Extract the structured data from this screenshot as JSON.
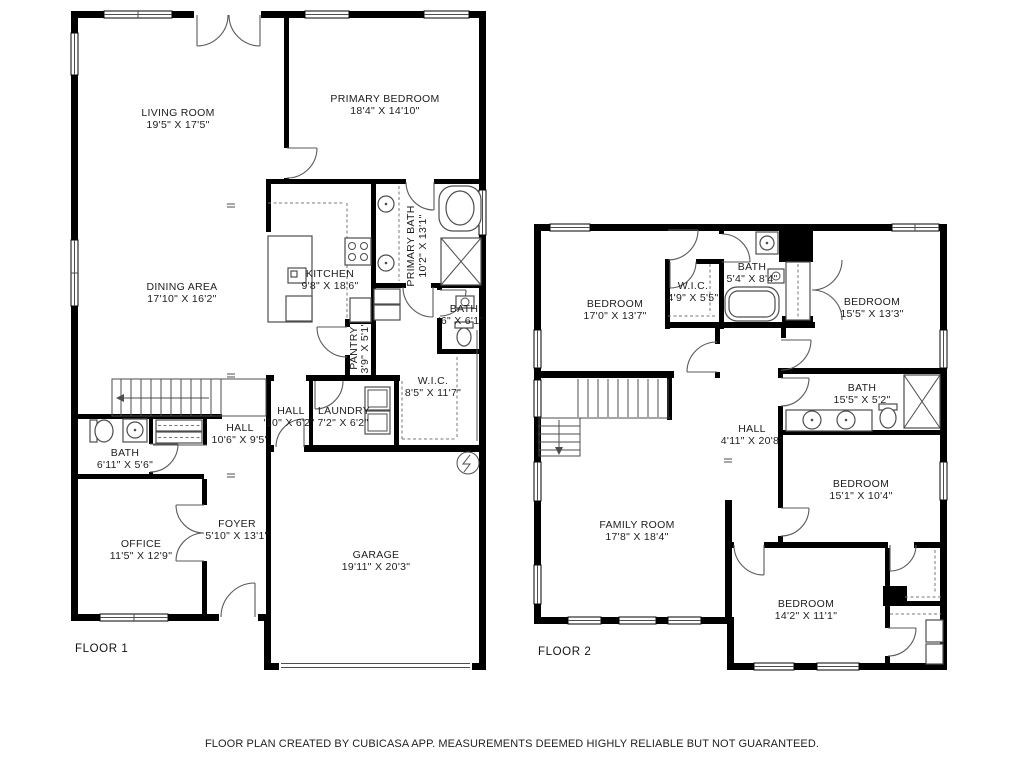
{
  "colors": {
    "background": "#ffffff",
    "wall": "#000000",
    "line": "#4d4d4d",
    "text": "#1d1d1d"
  },
  "footer": {
    "text": "FLOOR PLAN CREATED BY CUBICASA APP. MEASUREMENTS DEEMED HIGHLY RELIABLE BUT NOT GUARANTEED."
  },
  "floors": {
    "floor1": {
      "label": "FLOOR 1",
      "rooms": {
        "living_room": {
          "name": "LIVING ROOM",
          "dims": "19'5\" X 17'5\""
        },
        "primary_bedroom": {
          "name": "PRIMARY BEDROOM",
          "dims": "18'4\" X 14'10\""
        },
        "dining_area": {
          "name": "DINING AREA",
          "dims": "17'10\" X 16'2\""
        },
        "kitchen": {
          "name": "KITCHEN",
          "dims": "9'8\" X 18'6\""
        },
        "primary_bath": {
          "name": "PRIMARY BATH",
          "dims": "10'2\" X 13'1\""
        },
        "bath_small": {
          "name": "BATH",
          "dims": "'6\" X 6'1\""
        },
        "pantry": {
          "name": "PANTRY",
          "dims": "3'9\" X 5'1\""
        },
        "wic": {
          "name": "W.I.C.",
          "dims": "8'5\" X 11'7\""
        },
        "hall": {
          "name": "HALL",
          "dims": "10'6\" X 9'5\""
        },
        "hall_small": {
          "name": "HALL",
          "dims": "'10\" X 6'2\""
        },
        "laundry": {
          "name": "LAUNDRY",
          "dims": "7'2\" X 6'2\""
        },
        "bath": {
          "name": "BATH",
          "dims": "6'11\" X 5'6\""
        },
        "office": {
          "name": "OFFICE",
          "dims": "11'5\" X 12'9\""
        },
        "foyer": {
          "name": "FOYER",
          "dims": "5'10\" X 13'1\""
        },
        "garage": {
          "name": "GARAGE",
          "dims": "19'11\" X 20'3\""
        }
      }
    },
    "floor2": {
      "label": "FLOOR 2",
      "rooms": {
        "bedroom_tl": {
          "name": "BEDROOM",
          "dims": "17'0\" X 13'7\""
        },
        "wic": {
          "name": "W.I.C.",
          "dims": "4'9\" X 5'5\""
        },
        "bath_top": {
          "name": "BATH",
          "dims": "5'4\" X 8'4\""
        },
        "bedroom_tr": {
          "name": "BEDROOM",
          "dims": "15'5\" X 13'3\""
        },
        "bath_mid": {
          "name": "BATH",
          "dims": "15'5\" X 5'2\""
        },
        "hall": {
          "name": "HALL",
          "dims": "4'11\" X 20'8\""
        },
        "family_room": {
          "name": "FAMILY ROOM",
          "dims": "17'8\" X 18'4\""
        },
        "bedroom_mid": {
          "name": "BEDROOM",
          "dims": "15'1\" X 10'4\""
        },
        "bedroom_bottom": {
          "name": "BEDROOM",
          "dims": "14'2\" X 11'1\""
        }
      }
    }
  }
}
